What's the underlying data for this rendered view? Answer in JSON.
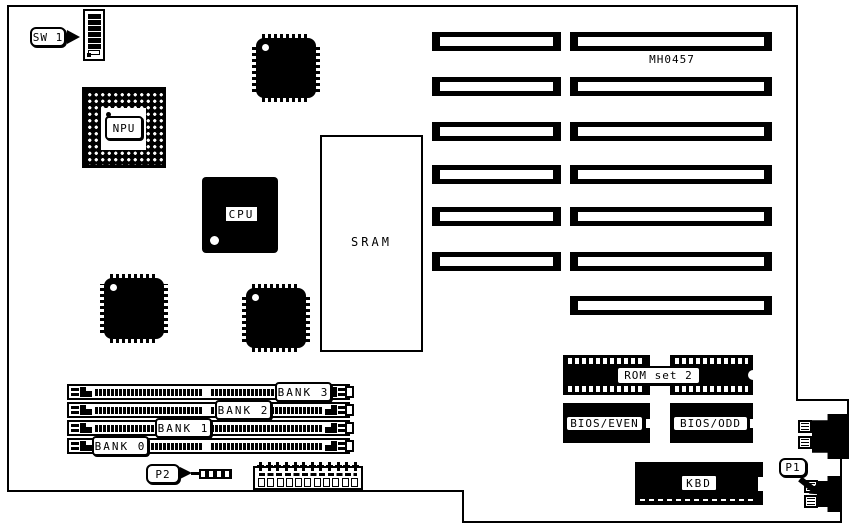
{
  "labels": {
    "sw1": "SW 1",
    "npu": "NPU",
    "cpu": "CPU",
    "sram": "SRAM",
    "board_id": "MH0457",
    "rom_set": "ROM set 2",
    "bios_even": "BIOS/EVEN",
    "bios_odd": "BIOS/ODD",
    "kbd": "KBD",
    "p1": "P1",
    "p2": "P2",
    "banks": [
      "BANK 3",
      "BANK 2",
      "BANK 1",
      "BANK 0"
    ]
  },
  "colors": {
    "ink": "#000000",
    "paper": "#ffffff"
  },
  "components": {
    "expansion_slots_left_column": 6,
    "expansion_slots_right_column": 7,
    "memory_bank_sockets": 4,
    "dip_switch_positions": 7
  }
}
